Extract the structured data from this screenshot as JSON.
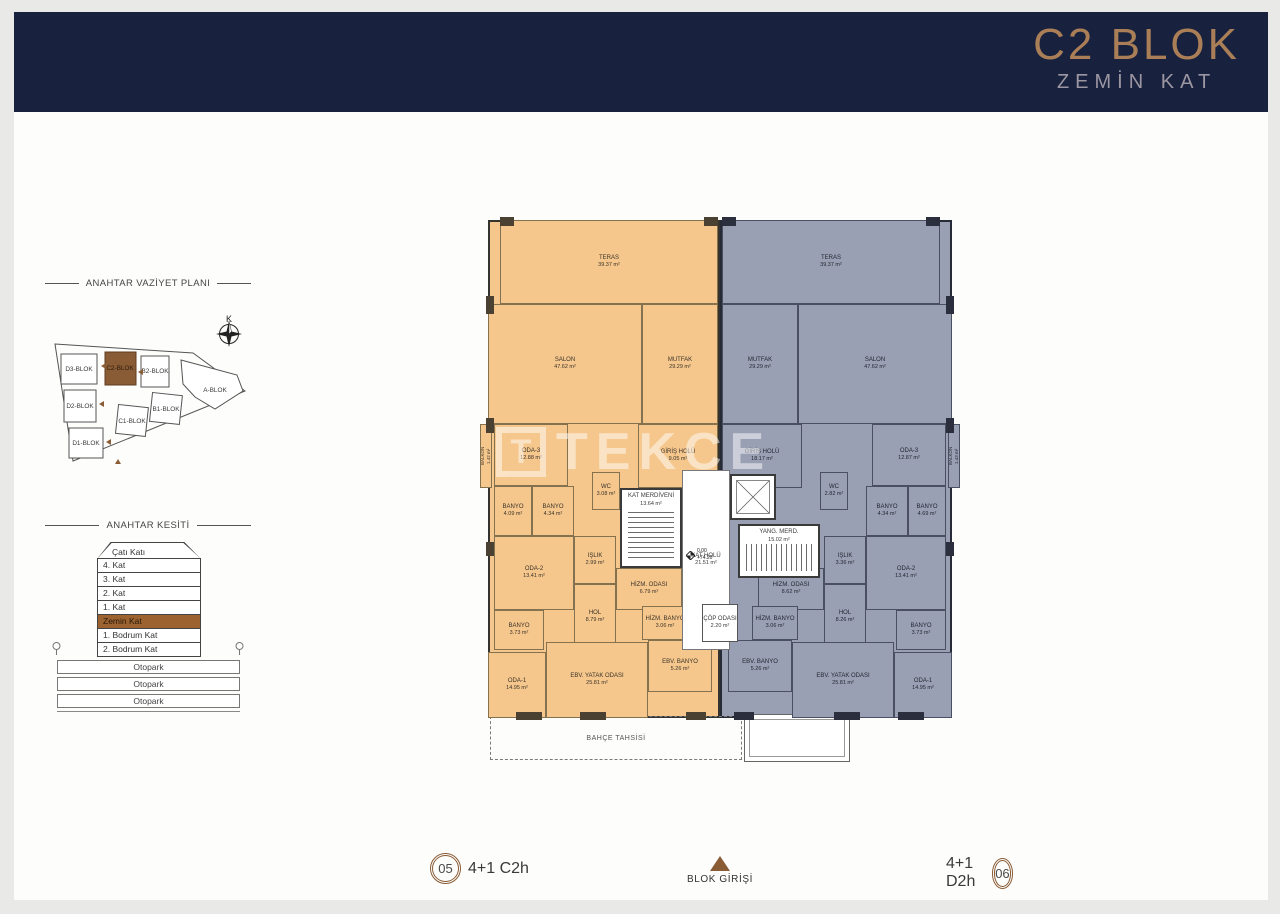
{
  "header": {
    "title": "C2 BLOK",
    "subtitle": "ZEMİN KAT"
  },
  "site_plan": {
    "title": "ANAHTAR VAZİYET PLANI",
    "north_label": "K",
    "highlight_color": "#8a5c35",
    "blocks": [
      {
        "label": "D3-BLOK"
      },
      {
        "label": "C2-BLOK",
        "highlight": true
      },
      {
        "label": "B2-BLOK"
      },
      {
        "label": "A-BLOK"
      },
      {
        "label": "D2-BLOK"
      },
      {
        "label": "B1-BLOK"
      },
      {
        "label": "C1-BLOK"
      },
      {
        "label": "D1-BLOK"
      }
    ]
  },
  "section": {
    "title": "ANAHTAR KESİTİ",
    "roof_label": "Çatı Katı",
    "floors": [
      "4. Kat",
      "3. Kat",
      "2. Kat",
      "1. Kat",
      "Zemin Kat",
      "1. Bodrum Kat",
      "2. Bodrum Kat"
    ],
    "highlight_floor": "Zemin Kat",
    "parking_rows": [
      "Otopark",
      "Otopark",
      "Otopark"
    ]
  },
  "plan": {
    "watermark": {
      "logo": "T",
      "text": "TEKCE"
    },
    "bahce": "BAHÇE TAHSİSİ",
    "entrance": "BLOK GİRİŞİ",
    "elevation": {
      "level": "0.00",
      "alt": "+74.20"
    },
    "tags": {
      "left": {
        "num": "05",
        "type": "4+1 C2h"
      },
      "right": {
        "num": "06",
        "type": "4+1 D2h"
      }
    },
    "units": [
      {
        "id": "left",
        "fill": "#f6c78c",
        "rooms": [
          {
            "n": "TERAS",
            "a": "39.37 m²",
            "r": [
              20,
              8,
              218,
              84
            ]
          },
          {
            "n": "SALON",
            "a": "47.62 m²",
            "r": [
              8,
              92,
              154,
              120
            ]
          },
          {
            "n": "MUTFAK",
            "a": "29.29 m²",
            "r": [
              162,
              92,
              76,
              120
            ]
          },
          {
            "n": "BALKON",
            "a": "1.42 m²",
            "r": [
              0,
              212,
              12,
              64
            ],
            "cls": "vert"
          },
          {
            "n": "ODA-3",
            "a": "12.88 m²",
            "r": [
              14,
              212,
              74,
              62
            ]
          },
          {
            "n": "GİRİŞ HOLÜ",
            "a": "9.05 m²",
            "r": [
              158,
              212,
              80,
              64
            ]
          },
          {
            "n": "WC",
            "a": "3.08 m²",
            "r": [
              112,
              260,
              28,
              38
            ]
          },
          {
            "n": "BANYO",
            "a": "4.09 m²",
            "r": [
              14,
              274,
              38,
              50
            ]
          },
          {
            "n": "BANYO",
            "a": "4.34 m²",
            "r": [
              52,
              274,
              42,
              50
            ]
          },
          {
            "n": "ODA-2",
            "a": "13.41 m²",
            "r": [
              14,
              324,
              80,
              74
            ]
          },
          {
            "n": "IŞLIK",
            "a": "2.99 m²",
            "r": [
              94,
              324,
              42,
              48
            ]
          },
          {
            "n": "HOL",
            "a": "8.79 m²",
            "r": [
              94,
              372,
              42,
              66
            ]
          },
          {
            "n": "HİZM. ODASI",
            "a": "6.79 m²",
            "r": [
              136,
              356,
              66,
              42
            ]
          },
          {
            "n": "HİZM. BANYO",
            "a": "3.06 m²",
            "r": [
              162,
              394,
              46,
              34
            ]
          },
          {
            "n": "BANYO",
            "a": "3.73 m²",
            "r": [
              14,
              398,
              50,
              40
            ]
          },
          {
            "n": "ODA-1",
            "a": "14.95 m²",
            "r": [
              8,
              440,
              58,
              66
            ]
          },
          {
            "n": "EBV. YATAK ODASI",
            "a": "25.81 m²",
            "r": [
              66,
              430,
              102,
              76
            ]
          },
          {
            "n": "EBV. BANYO",
            "a": "5.26 m²",
            "r": [
              168,
              428,
              64,
              52
            ]
          }
        ]
      },
      {
        "id": "right",
        "fill": "#9aa0b3",
        "rooms": [
          {
            "n": "TERAS",
            "a": "39.37 m²",
            "r": [
              242,
              8,
              218,
              84
            ]
          },
          {
            "n": "MUTFAK",
            "a": "29.29 m²",
            "r": [
              242,
              92,
              76,
              120
            ]
          },
          {
            "n": "SALON",
            "a": "47.62 m²",
            "r": [
              318,
              92,
              154,
              120
            ]
          },
          {
            "n": "GİRİŞ HOLÜ",
            "a": "18.17 m²",
            "r": [
              242,
              212,
              80,
              64
            ]
          },
          {
            "n": "ODA-3",
            "a": "12.87 m²",
            "r": [
              392,
              212,
              74,
              62
            ]
          },
          {
            "n": "BALKON",
            "a": "1.43 m²",
            "r": [
              468,
              212,
              12,
              64
            ],
            "cls": "vert"
          },
          {
            "n": "WC",
            "a": "2.82 m²",
            "r": [
              340,
              260,
              28,
              38
            ]
          },
          {
            "n": "BANYO",
            "a": "4.34 m²",
            "r": [
              386,
              274,
              42,
              50
            ]
          },
          {
            "n": "BANYO",
            "a": "4.69 m²",
            "r": [
              428,
              274,
              38,
              50
            ]
          },
          {
            "n": "ODA-2",
            "a": "13.41 m²",
            "r": [
              386,
              324,
              80,
              74
            ]
          },
          {
            "n": "IŞLIK",
            "a": "3.36 m²",
            "r": [
              344,
              324,
              42,
              48
            ]
          },
          {
            "n": "HOL",
            "a": "8.26 m²",
            "r": [
              344,
              372,
              42,
              66
            ]
          },
          {
            "n": "HİZM. ODASI",
            "a": "8.62 m²",
            "r": [
              278,
              356,
              66,
              42
            ]
          },
          {
            "n": "HİZM. BANYO",
            "a": "3.06 m²",
            "r": [
              272,
              394,
              46,
              34
            ]
          },
          {
            "n": "BANYO",
            "a": "3.73 m²",
            "r": [
              416,
              398,
              50,
              40
            ]
          },
          {
            "n": "ODA-1",
            "a": "14.95 m²",
            "r": [
              414,
              440,
              58,
              66
            ]
          },
          {
            "n": "EBV. YATAK ODASI",
            "a": "25.81 m²",
            "r": [
              312,
              430,
              102,
              76
            ]
          },
          {
            "n": "EBV. BANYO",
            "a": "5.26 m²",
            "r": [
              248,
              428,
              64,
              52
            ]
          }
        ]
      }
    ],
    "core": [
      {
        "n": "KAT MERDİVENİ",
        "a": "13.64 m²",
        "r": [
          140,
          276,
          62,
          80
        ],
        "cls": "stairs-h"
      },
      {
        "n": "KAT HOLÜ",
        "a": "21.51 m²",
        "r": [
          202,
          258,
          48,
          180
        ],
        "cls": "hall"
      },
      {
        "n": "",
        "a": "",
        "r": [
          250,
          262,
          46,
          46
        ],
        "cls": "lift"
      },
      {
        "n": "YANG. MERD.",
        "a": "15.02 m²",
        "r": [
          258,
          312,
          82,
          54
        ],
        "cls": "stairs-v"
      },
      {
        "n": "ÇÖP ODASI",
        "a": "2.20 m²",
        "r": [
          222,
          392,
          36,
          38
        ],
        "cls": "white"
      }
    ]
  }
}
